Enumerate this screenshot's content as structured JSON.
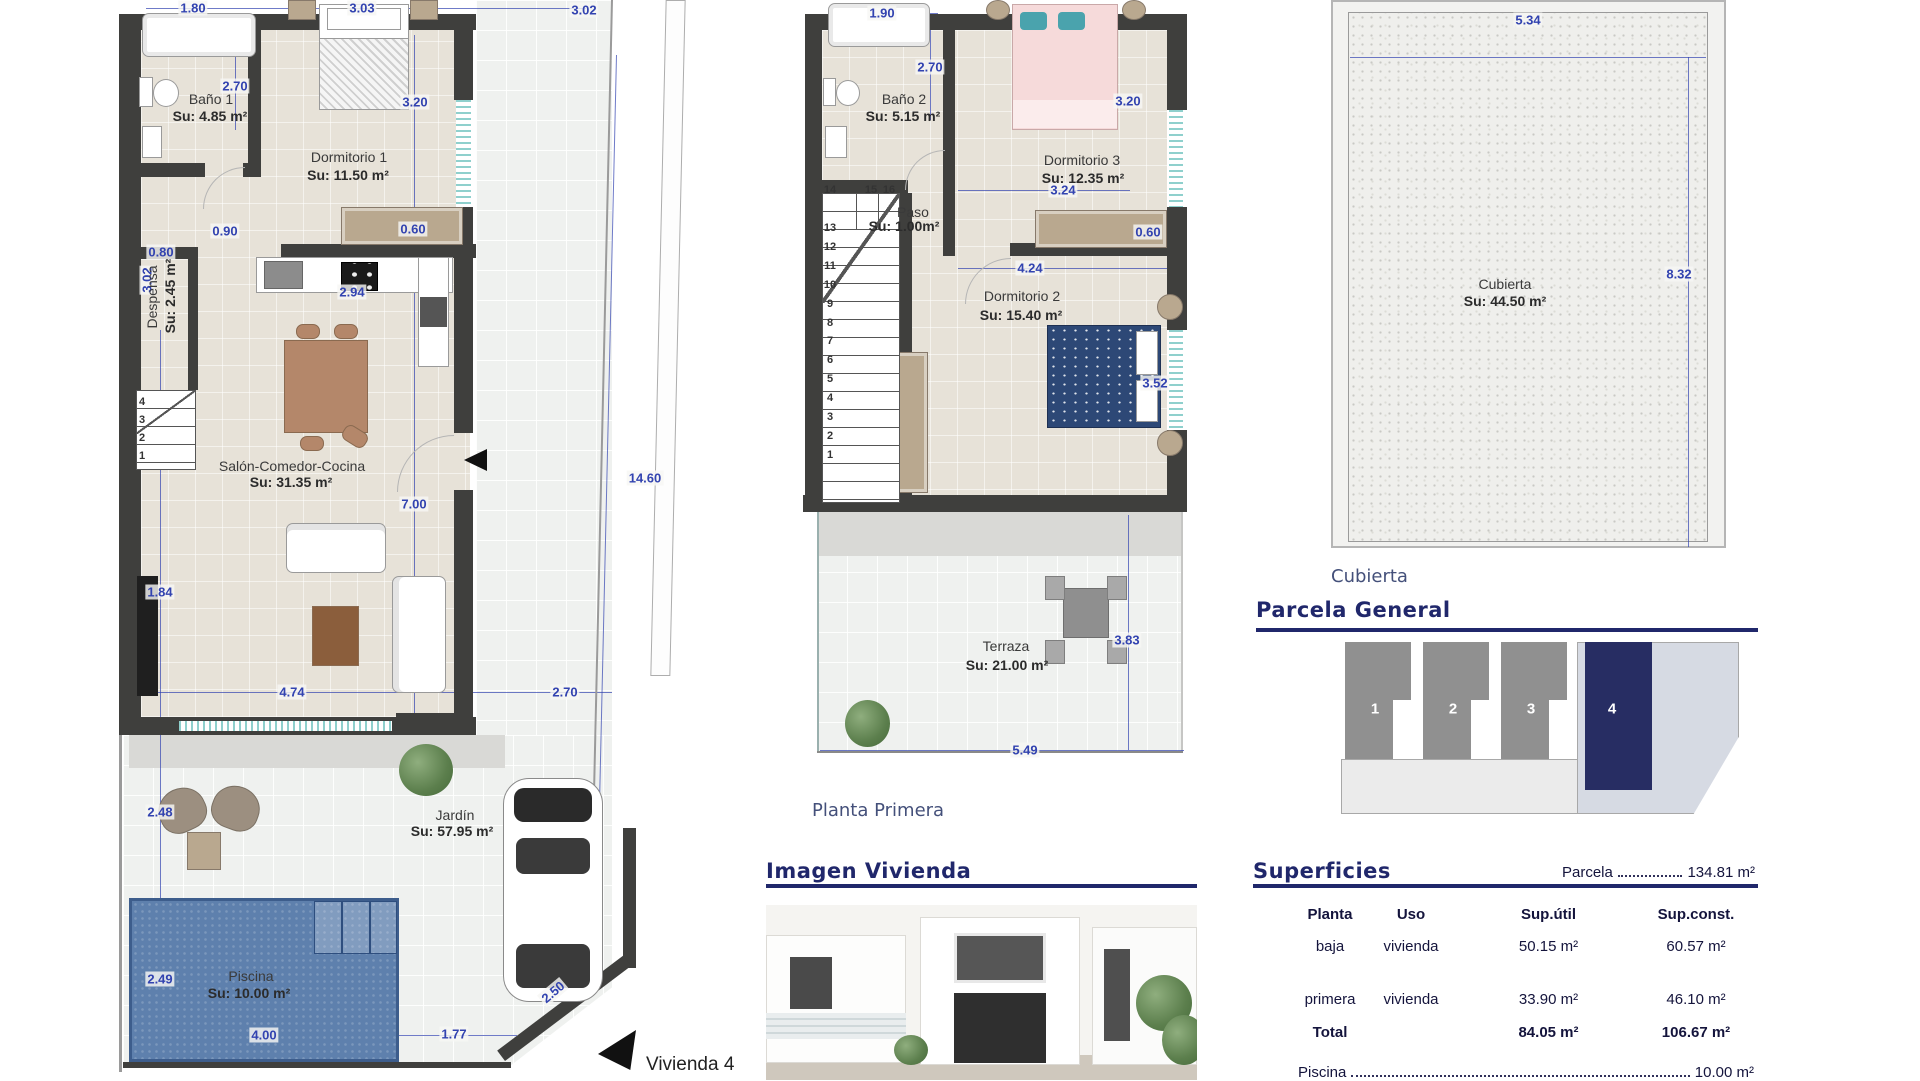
{
  "colors": {
    "dim_blue": "#3243b0",
    "wall": "#3f3f3d",
    "accent_navy": "#20276b",
    "pool_blue": "#5e80ad",
    "unit_highlight": "#272d63"
  },
  "headings": {
    "planta_primera": "Planta Primera",
    "cubierta_caption": "Cubierta",
    "parcela_general": "Parcela General",
    "superficies": "Superficies",
    "imagen_vivienda": "Imagen Vivienda",
    "vivienda_label": "Vivienda 4"
  },
  "parcela": {
    "units": [
      "1",
      "2",
      "3",
      "4"
    ]
  },
  "superficies": {
    "parcela_label": "Parcela",
    "parcela_value": "134.81 m²",
    "columns": [
      "Planta",
      "Uso",
      "Sup.útil",
      "Sup.const."
    ],
    "rows": [
      {
        "planta": "baja",
        "uso": "vivienda",
        "util": "50.15 m²",
        "const": "60.57 m²"
      },
      {
        "planta": "primera",
        "uso": "vivienda",
        "util": "33.90 m²",
        "const": "46.10 m²"
      }
    ],
    "total": {
      "label": "Total",
      "util": "84.05 m²",
      "const": "106.67 m²"
    },
    "piscina_label": "Piscina",
    "piscina_value": "10.00 m²"
  },
  "annotations": [
    {
      "t": "1.80",
      "x": 193,
      "y": 8,
      "c": "d"
    },
    {
      "t": "3.03",
      "x": 362,
      "y": 8,
      "c": "d"
    },
    {
      "t": "3.02",
      "x": 584,
      "y": 10,
      "c": "d"
    },
    {
      "t": "2.70",
      "x": 235,
      "y": 86,
      "c": "d"
    },
    {
      "t": "3.20",
      "x": 415,
      "y": 102,
      "c": "d"
    },
    {
      "t": "0.60",
      "x": 413,
      "y": 229,
      "c": "d"
    },
    {
      "t": "0.90",
      "x": 225,
      "y": 231,
      "c": "d"
    },
    {
      "t": "0.80",
      "x": 161,
      "y": 252,
      "c": "d"
    },
    {
      "t": "3.02",
      "x": 147,
      "y": 280,
      "c": "d",
      "r": -90
    },
    {
      "t": "2.94",
      "x": 352,
      "y": 292,
      "c": "d"
    },
    {
      "t": "7.00",
      "x": 414,
      "y": 504,
      "c": "d"
    },
    {
      "t": "14.60",
      "x": 645,
      "y": 478,
      "c": "d"
    },
    {
      "t": "1.84",
      "x": 160,
      "y": 592,
      "c": "d"
    },
    {
      "t": "4.74",
      "x": 292,
      "y": 692,
      "c": "d"
    },
    {
      "t": "2.70",
      "x": 565,
      "y": 692,
      "c": "d"
    },
    {
      "t": "2.48",
      "x": 160,
      "y": 812,
      "c": "d"
    },
    {
      "t": "2.49",
      "x": 160,
      "y": 979,
      "c": "d"
    },
    {
      "t": "4.00",
      "x": 264,
      "y": 1035,
      "c": "d"
    },
    {
      "t": "1.77",
      "x": 454,
      "y": 1034,
      "c": "d"
    },
    {
      "t": "2.50",
      "x": 553,
      "y": 992,
      "c": "d",
      "r": -40
    },
    {
      "t": "Baño 1",
      "x": 211,
      "y": 99,
      "c": "rn"
    },
    {
      "t": "Su: 4.85 m²",
      "x": 210,
      "y": 116,
      "c": "rb"
    },
    {
      "t": "Dormitorio 1",
      "x": 349,
      "y": 157,
      "c": "rn"
    },
    {
      "t": "Su: 11.50 m²",
      "x": 348,
      "y": 175,
      "c": "rb"
    },
    {
      "t": "Despensa",
      "x": 152,
      "y": 297,
      "c": "rn",
      "r": -90
    },
    {
      "t": "Su: 2.45 m²",
      "x": 170,
      "y": 296,
      "c": "rb",
      "r": -90
    },
    {
      "t": "Salón-Comedor-Cocina",
      "x": 292,
      "y": 466,
      "c": "rn"
    },
    {
      "t": "Su: 31.35 m²",
      "x": 291,
      "y": 482,
      "c": "rb"
    },
    {
      "t": "Jardín",
      "x": 455,
      "y": 815,
      "c": "rn"
    },
    {
      "t": "Su: 57.95 m²",
      "x": 452,
      "y": 831,
      "c": "rb"
    },
    {
      "t": "Piscina",
      "x": 251,
      "y": 976,
      "c": "rn"
    },
    {
      "t": "Su: 10.00 m²",
      "x": 249,
      "y": 993,
      "c": "rb"
    },
    {
      "t": "4",
      "x": 142,
      "y": 402,
      "c": "st"
    },
    {
      "t": "3",
      "x": 142,
      "y": 420,
      "c": "st"
    },
    {
      "t": "2",
      "x": 142,
      "y": 438,
      "c": "st"
    },
    {
      "t": "1",
      "x": 142,
      "y": 456,
      "c": "st"
    },
    {
      "t": "1.90",
      "x": 882,
      "y": 13,
      "c": "d"
    },
    {
      "t": "2.70",
      "x": 930,
      "y": 67,
      "c": "d"
    },
    {
      "t": "3.20",
      "x": 1128,
      "y": 101,
      "c": "d"
    },
    {
      "t": "3.24",
      "x": 1063,
      "y": 190,
      "c": "d"
    },
    {
      "t": "0.60",
      "x": 1148,
      "y": 232,
      "c": "d"
    },
    {
      "t": "4.24",
      "x": 1030,
      "y": 268,
      "c": "d"
    },
    {
      "t": "3.52",
      "x": 1155,
      "y": 383,
      "c": "d"
    },
    {
      "t": "3.83",
      "x": 1127,
      "y": 640,
      "c": "d"
    },
    {
      "t": "5.49",
      "x": 1025,
      "y": 750,
      "c": "d"
    },
    {
      "t": "Baño 2",
      "x": 904,
      "y": 99,
      "c": "rn"
    },
    {
      "t": "Su: 5.15 m²",
      "x": 903,
      "y": 116,
      "c": "rb"
    },
    {
      "t": "Paso",
      "x": 913,
      "y": 212,
      "c": "rn"
    },
    {
      "t": "Su: 1.00m²",
      "x": 904,
      "y": 226,
      "c": "rb"
    },
    {
      "t": "Dormitorio 3",
      "x": 1082,
      "y": 160,
      "c": "rn"
    },
    {
      "t": "Su: 12.35 m²",
      "x": 1083,
      "y": 178,
      "c": "rb"
    },
    {
      "t": "Dormitorio 2",
      "x": 1022,
      "y": 296,
      "c": "rn"
    },
    {
      "t": "Su: 15.40 m²",
      "x": 1021,
      "y": 315,
      "c": "rb"
    },
    {
      "t": "Terraza",
      "x": 1006,
      "y": 646,
      "c": "rn"
    },
    {
      "t": "Su: 21.00 m²",
      "x": 1007,
      "y": 665,
      "c": "rb"
    },
    {
      "t": "14",
      "x": 830,
      "y": 190,
      "c": "st"
    },
    {
      "t": "15",
      "x": 871,
      "y": 190,
      "c": "st"
    },
    {
      "t": "16",
      "x": 889,
      "y": 190,
      "c": "st"
    },
    {
      "t": "13",
      "x": 830,
      "y": 228,
      "c": "st"
    },
    {
      "t": "12",
      "x": 830,
      "y": 247,
      "c": "st"
    },
    {
      "t": "11",
      "x": 830,
      "y": 266,
      "c": "st"
    },
    {
      "t": "10",
      "x": 830,
      "y": 285,
      "c": "st"
    },
    {
      "t": "9",
      "x": 830,
      "y": 304,
      "c": "st"
    },
    {
      "t": "8",
      "x": 830,
      "y": 323,
      "c": "st"
    },
    {
      "t": "7",
      "x": 830,
      "y": 341,
      "c": "st"
    },
    {
      "t": "6",
      "x": 830,
      "y": 360,
      "c": "st"
    },
    {
      "t": "5",
      "x": 830,
      "y": 379,
      "c": "st"
    },
    {
      "t": "4",
      "x": 830,
      "y": 398,
      "c": "st"
    },
    {
      "t": "3",
      "x": 830,
      "y": 417,
      "c": "st"
    },
    {
      "t": "2",
      "x": 830,
      "y": 436,
      "c": "st"
    },
    {
      "t": "1",
      "x": 830,
      "y": 455,
      "c": "st"
    },
    {
      "t": "5.34",
      "x": 1528,
      "y": 20,
      "c": "d"
    },
    {
      "t": "8.32",
      "x": 1679,
      "y": 274,
      "c": "d"
    },
    {
      "t": "Cubierta",
      "x": 1505,
      "y": 284,
      "c": "rn"
    },
    {
      "t": "Su: 44.50 m²",
      "x": 1505,
      "y": 301,
      "c": "rb"
    }
  ]
}
